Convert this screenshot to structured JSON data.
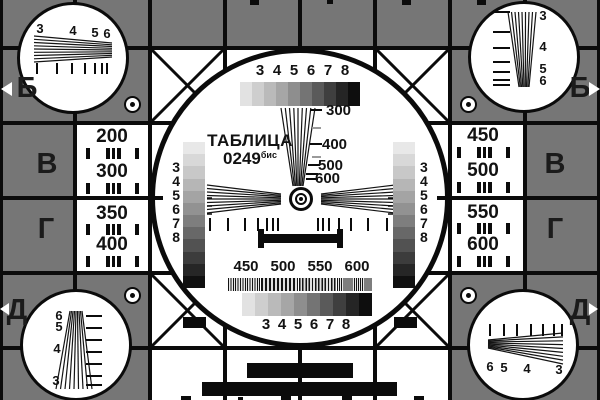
{
  "colors": {
    "background": "#767676",
    "ink": "#0b0b0b",
    "white": "#ffffff",
    "mid_tick": "#9a9a9a"
  },
  "title": {
    "word": "ТАБЛИЦА",
    "number": "0249",
    "suffix": "бис"
  },
  "edge_markers": {
    "left": [
      {
        "letter": "Б"
      },
      {
        "letter": "В"
      },
      {
        "letter": "Г"
      },
      {
        "letter": "Д"
      }
    ],
    "right": [
      {
        "letter": "Б"
      },
      {
        "letter": "В"
      },
      {
        "letter": "Г"
      },
      {
        "letter": "Д"
      }
    ]
  },
  "side_frequency_cells": {
    "left": [
      "200",
      "300",
      "350",
      "400"
    ],
    "right": [
      "450",
      "500",
      "550",
      "600"
    ]
  },
  "corner_dials": {
    "top_left": [
      "3",
      "4",
      "5",
      "6"
    ],
    "top_right": [
      "3",
      "4",
      "5",
      "6"
    ],
    "bottom_left": [
      "6",
      "5",
      "4",
      "3"
    ],
    "bottom_right": [
      "6",
      "5",
      "4",
      "3"
    ]
  },
  "center": {
    "top_scale_labels": [
      "3",
      "4",
      "5",
      "6",
      "7",
      "8"
    ],
    "bottom_scale_labels": [
      "3",
      "4",
      "5",
      "6",
      "7",
      "8"
    ],
    "wedge_labels": [
      "300",
      "400",
      "500",
      "600"
    ],
    "strip_labels": [
      "3",
      "4",
      "5",
      "6",
      "7",
      "8"
    ],
    "burst_labels": [
      "450",
      "500",
      "550",
      "600"
    ],
    "gray_steps": [
      "#e2e2e2",
      "#cecece",
      "#bababa",
      "#a6a6a6",
      "#8e8e8e",
      "#747474",
      "#5a5a5a",
      "#3f3f3f",
      "#252525",
      "#0e0e0e"
    ],
    "strip_steps": [
      "#e8e8e8",
      "#d8d8d8",
      "#c8c8c8",
      "#b6b6b6",
      "#a4a4a4",
      "#929292",
      "#7e7e7e",
      "#686868",
      "#525252",
      "#3c3c3c",
      "#262626",
      "#101010"
    ]
  }
}
